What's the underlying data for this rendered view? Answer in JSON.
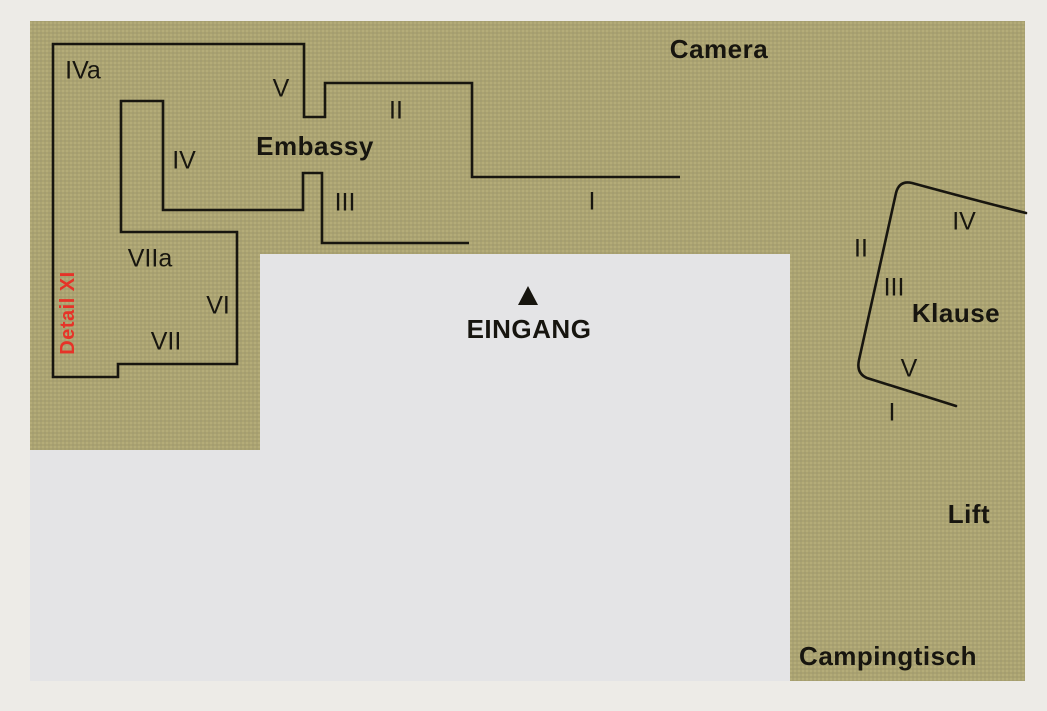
{
  "colors": {
    "margin": "#edebe7",
    "interior": "#e4e4e6",
    "terrain": "#aba372",
    "ink": "#17150f",
    "red": "#e63328"
  },
  "terrain": {
    "outline_points": "30,21 1025,21 1025,681 790,681 790,254 260,254 260,450 30,450"
  },
  "paths": {
    "embassy_wall": "M 680 177 L 472 177 L 472 83 L 325 83 L 325 117 L 304 117 L 304 44 L 53 44 L 53 377 L 118 377 L 118 364 L 237 364 L 237 232 L 121 232 L 121 101 L 163 101 L 163 210 L 303 210 L 303 173 L 322 173 L 322 243 L 469 243",
    "klause_wall": "M 1026 213 C 978 201 934 189 912 183 C 903 181 898 185 896 193 L 859 360 C 857 369 860 375 867 378 L 956 406",
    "eingang_triangle": "528,286 518,305 538,305"
  },
  "labels": [
    {
      "id": "camera",
      "text": "Camera",
      "kind": "name",
      "x": 719,
      "y": 49
    },
    {
      "id": "sector-iva",
      "text": "IVa",
      "kind": "numeral",
      "x": 83,
      "y": 71
    },
    {
      "id": "sector-v-embassy",
      "text": "V",
      "kind": "numeral",
      "x": 281,
      "y": 89
    },
    {
      "id": "sector-ii-embassy",
      "text": "II",
      "kind": "numeral",
      "x": 396,
      "y": 111
    },
    {
      "id": "embassy",
      "text": "Embassy",
      "kind": "name",
      "x": 315,
      "y": 146
    },
    {
      "id": "sector-iv-embassy",
      "text": "IV",
      "kind": "numeral",
      "x": 184,
      "y": 161
    },
    {
      "id": "sector-iii-embassy",
      "text": "III",
      "kind": "numeral",
      "x": 345,
      "y": 203
    },
    {
      "id": "sector-i-embassy",
      "text": "I",
      "kind": "numeral",
      "x": 592,
      "y": 202
    },
    {
      "id": "sector-viia",
      "text": "VIIa",
      "kind": "numeral",
      "x": 150,
      "y": 259
    },
    {
      "id": "sector-vi",
      "text": "VI",
      "kind": "numeral",
      "x": 218,
      "y": 306
    },
    {
      "id": "sector-vii",
      "text": "VII",
      "kind": "numeral",
      "x": 166,
      "y": 342
    },
    {
      "id": "detail-xi",
      "text": "Detail XI",
      "kind": "detail",
      "x": 68,
      "y": 313,
      "rotate": -90
    },
    {
      "id": "eingang",
      "text": "EINGANG",
      "kind": "name",
      "x": 529,
      "y": 329
    },
    {
      "id": "sector-iv-klause",
      "text": "IV",
      "kind": "numeral",
      "x": 964,
      "y": 222
    },
    {
      "id": "sector-ii-klause",
      "text": "II",
      "kind": "numeral",
      "x": 861,
      "y": 249
    },
    {
      "id": "sector-iii-klause",
      "text": "III",
      "kind": "numeral",
      "x": 894,
      "y": 288
    },
    {
      "id": "klause",
      "text": "Klause",
      "kind": "name",
      "x": 956,
      "y": 313
    },
    {
      "id": "sector-v-klause",
      "text": "V",
      "kind": "numeral",
      "x": 909,
      "y": 369
    },
    {
      "id": "sector-i-klause",
      "text": "I",
      "kind": "numeral",
      "x": 892,
      "y": 413
    },
    {
      "id": "lift",
      "text": "Lift",
      "kind": "name",
      "x": 969,
      "y": 514
    },
    {
      "id": "campingtisch",
      "text": "Campingtisch",
      "kind": "name",
      "x": 888,
      "y": 656
    }
  ]
}
